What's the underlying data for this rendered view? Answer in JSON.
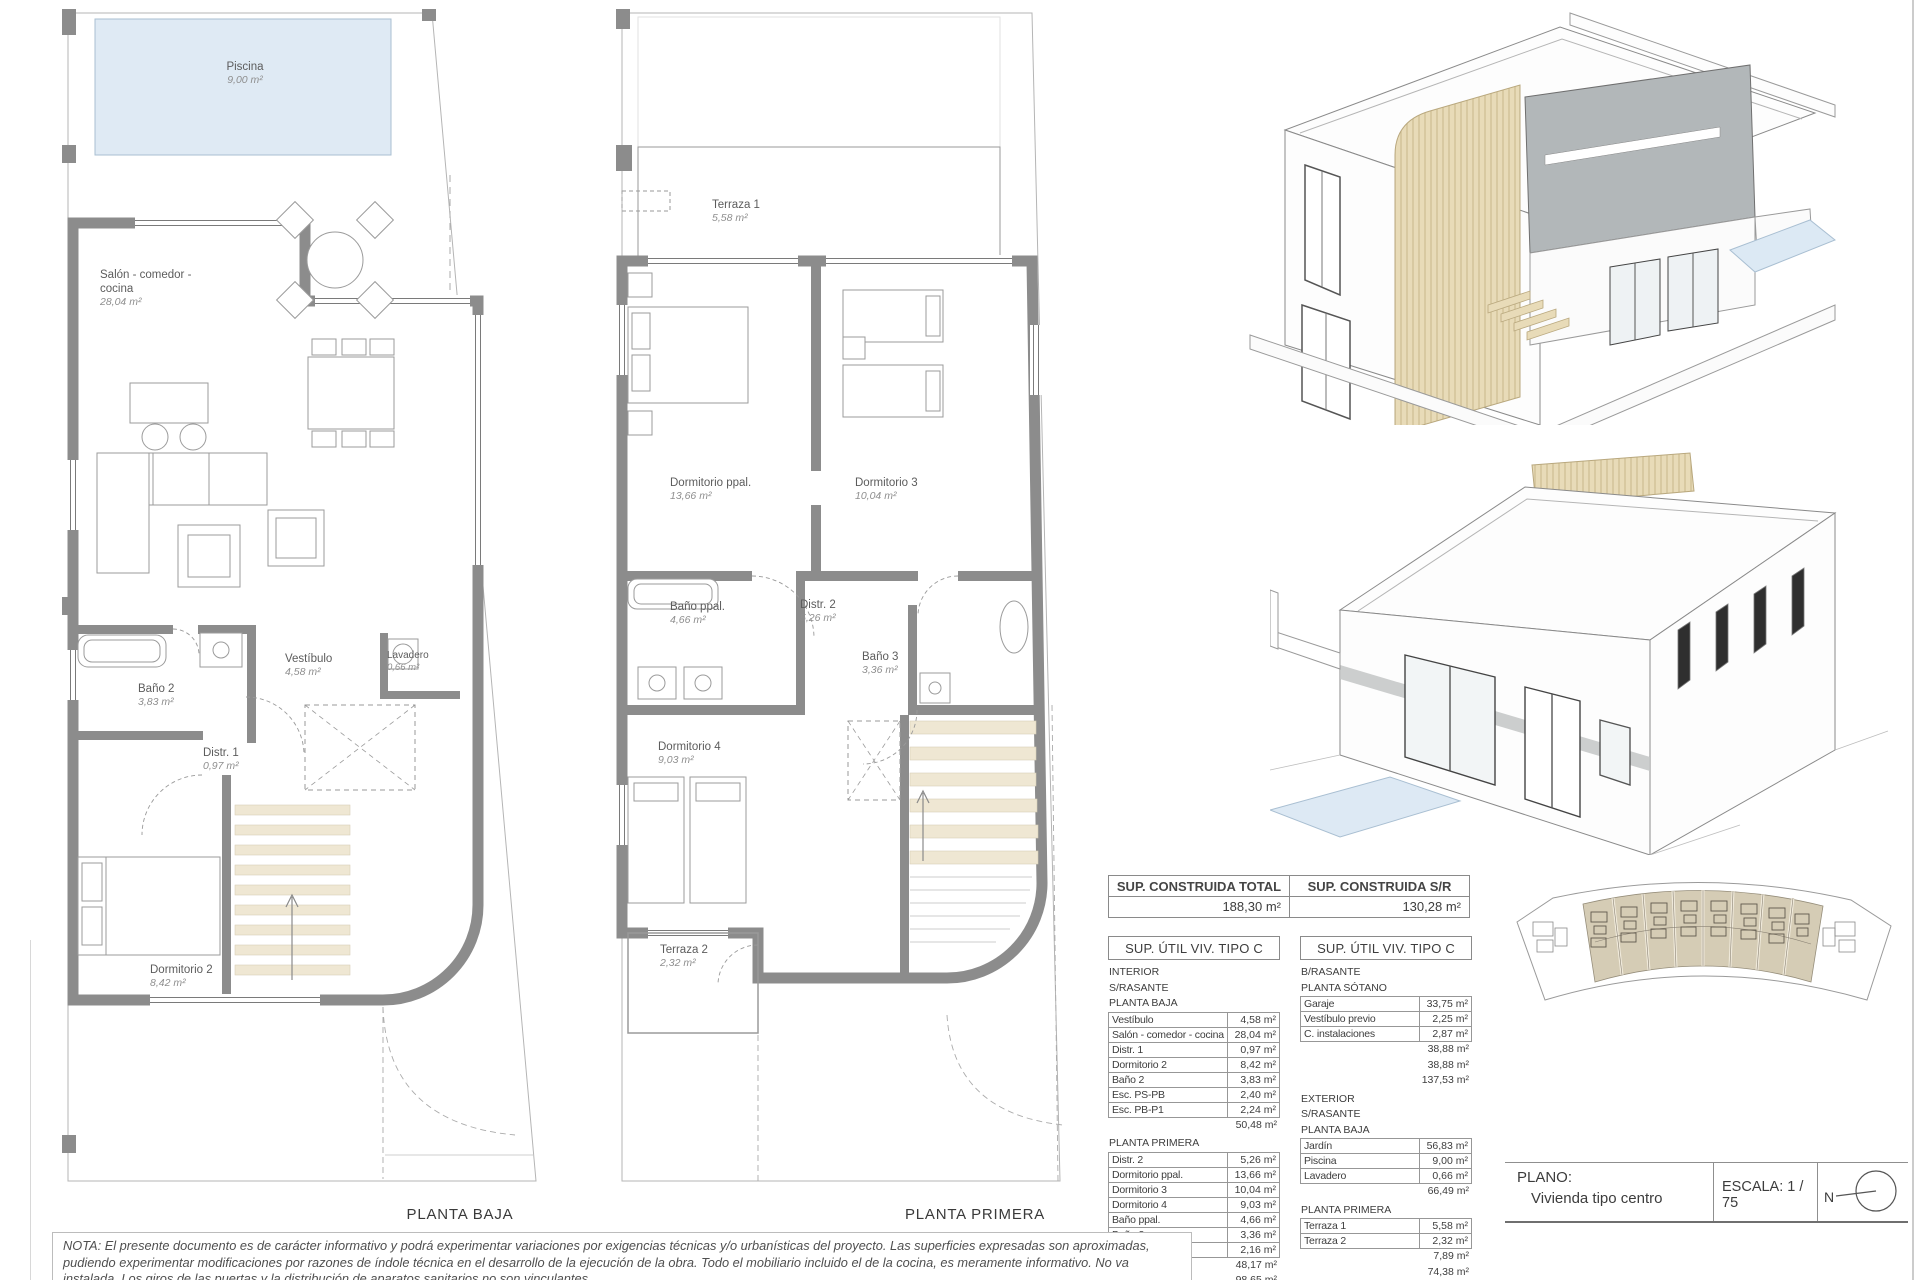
{
  "sheet": {
    "plans": {
      "planta_baja": {
        "title": "PLANTA BAJA",
        "rooms": [
          {
            "name": "Piscina",
            "area": "9,00 m²"
          },
          {
            "name": "Salón - comedor - cocina",
            "area": "28,04 m²"
          },
          {
            "name": "Vestíbulo",
            "area": "4,58 m²"
          },
          {
            "name": "Lavadero",
            "area": "0,66 m²"
          },
          {
            "name": "Baño 2",
            "area": "3,83 m²"
          },
          {
            "name": "Distr. 1",
            "area": "0,97 m²"
          },
          {
            "name": "Dormitorio 2",
            "area": "8,42 m²"
          }
        ]
      },
      "planta_primera": {
        "title": "PLANTA PRIMERA",
        "rooms": [
          {
            "name": "Terraza 1",
            "area": "5,58 m²"
          },
          {
            "name": "Dormitorio ppal.",
            "area": "13,66 m²"
          },
          {
            "name": "Dormitorio 3",
            "area": "10,04 m²"
          },
          {
            "name": "Baño ppal.",
            "area": "4,66 m²"
          },
          {
            "name": "Distr. 2",
            "area": "5,26 m²"
          },
          {
            "name": "Baño 3",
            "area": "3,36 m²"
          },
          {
            "name": "Dormitorio 4",
            "area": "9,03 m²"
          },
          {
            "name": "Terraza 2",
            "area": "2,32 m²"
          }
        ]
      }
    },
    "tables": {
      "construida": {
        "total": {
          "header": "SUP. CONSTRUIDA TOTAL",
          "value": "188,30 m²"
        },
        "sr": {
          "header": "SUP. CONSTRUIDA S/R",
          "value": "130,28 m²"
        }
      },
      "util_interior": {
        "header": "SUP. ÚTIL VIV. TIPO C",
        "groups": [
          {
            "headings": [
              "INTERIOR",
              "S/RASANTE",
              "PLANTA BAJA"
            ],
            "rows": [
              [
                "Vestíbulo",
                "4,58 m²"
              ],
              [
                "Salón - comedor - cocina",
                "28,04 m²"
              ],
              [
                "Distr. 1",
                "0,97 m²"
              ],
              [
                "Dormitorio 2",
                "8,42 m²"
              ],
              [
                "Baño 2",
                "3,83 m²"
              ],
              [
                "Esc. PS-PB",
                "2,40 m²"
              ],
              [
                "Esc. PB-P1",
                "2,24 m²"
              ]
            ],
            "totals": [
              "50,48 m²"
            ]
          },
          {
            "headings": [
              "PLANTA PRIMERA"
            ],
            "rows": [
              [
                "Distr. 2",
                "5,26 m²"
              ],
              [
                "Dormitorio ppal.",
                "13,66 m²"
              ],
              [
                "Dormitorio 3",
                "10,04 m²"
              ],
              [
                "Dormitorio 4",
                "9,03 m²"
              ],
              [
                "Baño ppal.",
                "4,66 m²"
              ],
              [
                "Baño 3",
                "3,36 m²"
              ],
              [
                "Esc. PB-P1",
                "2,16 m²"
              ]
            ],
            "totals": [
              "48,17 m²",
              "98,65 m²"
            ]
          }
        ]
      },
      "util_exterior": {
        "header": "SUP. ÚTIL VIV. TIPO C",
        "groups": [
          {
            "headings": [
              "B/RASANTE",
              "PLANTA SÓTANO"
            ],
            "rows": [
              [
                "Garaje",
                "33,75 m²"
              ],
              [
                "Vestíbulo previo",
                "2,25 m²"
              ],
              [
                "C. instalaciones",
                "2,87 m²"
              ]
            ],
            "totals": [
              "38,88 m²",
              "38,88 m²",
              "137,53 m²"
            ]
          },
          {
            "headings": [
              "EXTERIOR",
              "S/RASANTE",
              "PLANTA BAJA"
            ],
            "rows": [
              [
                "Jardín",
                "56,83 m²"
              ],
              [
                "Piscina",
                "9,00 m²"
              ],
              [
                "Lavadero",
                "0,66 m²"
              ]
            ],
            "totals": [
              "66,49 m²"
            ]
          },
          {
            "headings": [
              "PLANTA PRIMERA"
            ],
            "rows": [
              [
                "Terraza 1",
                "5,58 m²"
              ],
              [
                "Terraza 2",
                "2,32 m²"
              ]
            ],
            "totals": [
              "7,89 m²",
              "74,38 m²",
              "74,38 m²"
            ]
          }
        ]
      }
    },
    "titleblock": {
      "plano_label": "PLANO:",
      "plano_value": "Vivienda tipo centro",
      "escala_label": "ESCALA:  1 / 75",
      "north_label": "N"
    },
    "note": "NOTA: El presente documento es de carácter informativo y podrá experimentar variaciones por exigencias técnicas y/o urbanísticas del proyecto. Las superficies expresadas son aproximadas, pudiendo experimentar modificaciones por razones de índole técnica en el desarrollo de la ejecución de la obra. Todo el mobiliario incluido el de la cocina, es meramente informativo. No va instalada. Los giros de las puertas y la distribución de aparatos sanitarios no son vinculantes.",
    "icons": {
      "north_compass": "compass-circle-with-needle"
    },
    "colors": {
      "wall": "#8c8c8c",
      "pool": "#dfeaf4",
      "wood_accent": "#e8dbb8",
      "siteplan_unit": "#d5ccb5",
      "gray_volume": "#b2b7b9"
    }
  }
}
